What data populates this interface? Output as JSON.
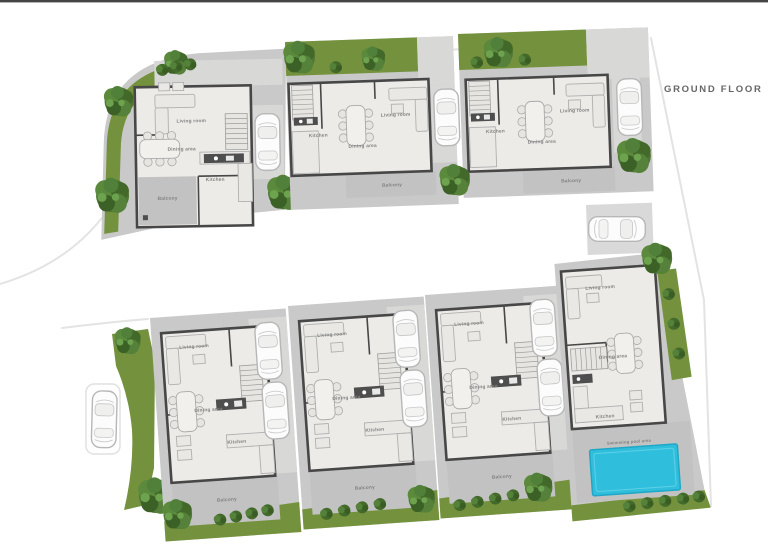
{
  "title": "GROUND FLOOR",
  "houses": [
    {
      "name": "House 1",
      "position": "top-left-corner",
      "rooms": {
        "living": "Living room",
        "dining": "Dining area",
        "kitchen": "Kitchen",
        "balcony": "Balcony"
      }
    },
    {
      "name": "House 2",
      "position": "top-middle",
      "rooms": {
        "living": "Living room",
        "dining": "Dining area",
        "kitchen": "Kitchen",
        "balcony": "Balcony"
      }
    },
    {
      "name": "House 3",
      "position": "top-right",
      "rooms": {
        "living": "Living room",
        "dining": "Dining area",
        "kitchen": "Kitchen",
        "balcony": "Balcony"
      }
    },
    {
      "name": "House 4",
      "position": "bottom-1",
      "rooms": {
        "living": "Living room",
        "dining": "Dining area",
        "kitchen": "Kitchen",
        "balcony": "Balcony"
      }
    },
    {
      "name": "House 5",
      "position": "bottom-2",
      "rooms": {
        "living": "Living room",
        "dining": "Dining area",
        "kitchen": "Kitchen",
        "balcony": "Balcony"
      }
    },
    {
      "name": "House 6",
      "position": "bottom-3",
      "rooms": {
        "living": "Living room",
        "dining": "Dining area",
        "kitchen": "Kitchen",
        "balcony": "Balcony"
      }
    },
    {
      "name": "House 7",
      "position": "bottom-right",
      "rooms": {
        "living": "Living room",
        "dining": "Dining area",
        "kitchen": "Kitchen",
        "pool": "Swimming pool area"
      }
    }
  ],
  "colors": {
    "paving": "#c9c9c9",
    "driveway": "#d8d8d7",
    "floor": "#edebe7",
    "wall": "#474747",
    "grass": "#74923d",
    "pool": "#2fbfdc",
    "road": "#ffffff",
    "balcony": "#c2c2c2",
    "title_text": "#666666",
    "top_bar": "#454545"
  }
}
